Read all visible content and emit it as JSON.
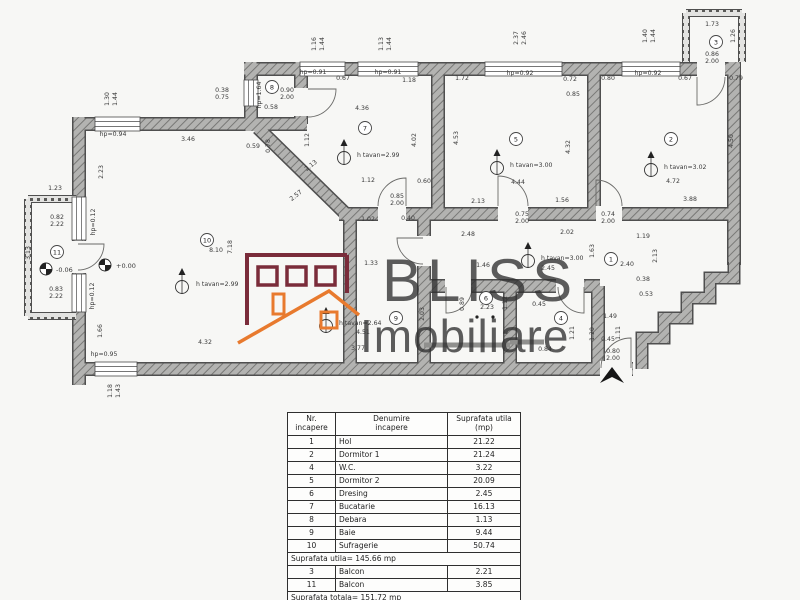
{
  "watermark": {
    "line1": "BLISS",
    "line2": "Imobiliare",
    "brand_maroon": "#7a2c3a",
    "brand_orange": "#e87a2e",
    "text_color": "#303030"
  },
  "plan": {
    "wall_color": "#4f4f4f",
    "dim_color": "#3a3a3a",
    "rooms": [
      {
        "n": "1",
        "x": 611,
        "y": 259
      },
      {
        "n": "2",
        "x": 671,
        "y": 139
      },
      {
        "n": "3",
        "x": 716,
        "y": 42
      },
      {
        "n": "4",
        "x": 561,
        "y": 318
      },
      {
        "n": "5",
        "x": 516,
        "y": 139
      },
      {
        "n": "6",
        "x": 486,
        "y": 298
      },
      {
        "n": "7",
        "x": 365,
        "y": 128
      },
      {
        "n": "8",
        "x": 272,
        "y": 87
      },
      {
        "n": "9",
        "x": 396,
        "y": 318
      },
      {
        "n": "10",
        "x": 207,
        "y": 240
      },
      {
        "n": "11",
        "x": 57,
        "y": 252
      }
    ],
    "ceiling_markers": [
      {
        "label": "h tavan=2.99",
        "tx": 196,
        "ty": 286,
        "mx": 182,
        "my": 282
      },
      {
        "label": "h tavan=2.99",
        "tx": 357,
        "ty": 157,
        "mx": 344,
        "my": 153
      },
      {
        "label": "h tavan=3.00",
        "tx": 510,
        "ty": 167,
        "mx": 497,
        "my": 163
      },
      {
        "label": "h tavan=3.00",
        "tx": 541,
        "ty": 260,
        "mx": 528,
        "my": 256
      },
      {
        "label": "h tavan=3.02",
        "tx": 664,
        "ty": 169,
        "mx": 651,
        "my": 165
      },
      {
        "label": "h tavan=2.64",
        "tx": 339,
        "ty": 325,
        "mx": 326,
        "my": 321
      }
    ],
    "levels": [
      {
        "label": "-0.06",
        "tx": 56,
        "ty": 272,
        "mx": 46,
        "my": 269
      },
      {
        "label": "+0.00",
        "tx": 116,
        "ty": 268,
        "mx": 105,
        "my": 265
      }
    ],
    "dims": [
      {
        "t": "1.16",
        "x": 316,
        "y": 44,
        "r": -90
      },
      {
        "t": "1.44",
        "x": 324,
        "y": 44,
        "r": -90
      },
      {
        "t": "1.13",
        "x": 383,
        "y": 44,
        "r": -90
      },
      {
        "t": "1.44",
        "x": 391,
        "y": 44,
        "r": -90
      },
      {
        "t": "2.37",
        "x": 518,
        "y": 38,
        "r": -90
      },
      {
        "t": "2.46",
        "x": 526,
        "y": 38,
        "r": -90
      },
      {
        "t": "1.40",
        "x": 647,
        "y": 36,
        "r": -90
      },
      {
        "t": "1.44",
        "x": 655,
        "y": 36,
        "r": -90
      },
      {
        "t": "1.30",
        "x": 109,
        "y": 99,
        "r": -90
      },
      {
        "t": "1.44",
        "x": 117,
        "y": 99,
        "r": -90
      },
      {
        "t": "1.18",
        "x": 112,
        "y": 391,
        "r": -90
      },
      {
        "t": "1.43",
        "x": 120,
        "y": 391,
        "r": -90
      },
      {
        "t": "hp=0.91",
        "x": 313,
        "y": 74
      },
      {
        "t": "0.67",
        "x": 343,
        "y": 80
      },
      {
        "t": "hp=0.91",
        "x": 388,
        "y": 74
      },
      {
        "t": "1.18",
        "x": 409,
        "y": 82
      },
      {
        "t": "1.72",
        "x": 462,
        "y": 80
      },
      {
        "t": "hp=0.92",
        "x": 520,
        "y": 75
      },
      {
        "t": "0.72",
        "x": 570,
        "y": 81
      },
      {
        "t": "0.85",
        "x": 573,
        "y": 96
      },
      {
        "t": "0.80",
        "x": 608,
        "y": 80
      },
      {
        "t": "hp=0.92",
        "x": 648,
        "y": 75
      },
      {
        "t": "0.67",
        "x": 685,
        "y": 80
      },
      {
        "t": "0.79",
        "x": 736,
        "y": 80
      },
      {
        "t": "1.73",
        "x": 712,
        "y": 26
      },
      {
        "t": "1.26",
        "x": 735,
        "y": 36,
        "r": -90
      },
      {
        "t": "0.86",
        "x": 712,
        "y": 56
      },
      {
        "t": "2.00",
        "x": 712,
        "y": 63
      },
      {
        "t": "0.38",
        "x": 222,
        "y": 92
      },
      {
        "t": "0.75",
        "x": 222,
        "y": 99
      },
      {
        "t": "hp=1.64",
        "x": 261,
        "y": 95,
        "r": -90
      },
      {
        "t": "0.90",
        "x": 287,
        "y": 92
      },
      {
        "t": "2.00",
        "x": 287,
        "y": 99
      },
      {
        "t": "0.58",
        "x": 271,
        "y": 109
      },
      {
        "t": "0.59",
        "x": 253,
        "y": 148
      },
      {
        "t": "0.78",
        "x": 270,
        "y": 146,
        "r": -90
      },
      {
        "t": "hp=0.94",
        "x": 113,
        "y": 136
      },
      {
        "t": "3.46",
        "x": 188,
        "y": 141
      },
      {
        "t": "2.23",
        "x": 103,
        "y": 172,
        "r": -90
      },
      {
        "t": "1.23",
        "x": 55,
        "y": 190
      },
      {
        "t": "0.82",
        "x": 57,
        "y": 219
      },
      {
        "t": "2.22",
        "x": 57,
        "y": 226
      },
      {
        "t": "hp=0.12",
        "x": 95,
        "y": 222,
        "r": -90
      },
      {
        "t": "3.13",
        "x": 30,
        "y": 253,
        "r": -90
      },
      {
        "t": "0.83",
        "x": 56,
        "y": 291
      },
      {
        "t": "2.22",
        "x": 56,
        "y": 298
      },
      {
        "t": "hp=0.12",
        "x": 94,
        "y": 296,
        "r": -90
      },
      {
        "t": "1.66",
        "x": 102,
        "y": 331,
        "r": -90
      },
      {
        "t": "hp=0.95",
        "x": 104,
        "y": 356
      },
      {
        "t": "4.32",
        "x": 205,
        "y": 344
      },
      {
        "t": "8.10",
        "x": 216,
        "y": 252
      },
      {
        "t": "7.18",
        "x": 232,
        "y": 247,
        "r": -90
      },
      {
        "t": "4.36",
        "x": 362,
        "y": 110
      },
      {
        "t": "1.12",
        "x": 309,
        "y": 140,
        "r": -90
      },
      {
        "t": "2.13",
        "x": 312,
        "y": 167,
        "r": -38
      },
      {
        "t": "2.57",
        "x": 297,
        "y": 197,
        "r": -38
      },
      {
        "t": "1.12",
        "x": 368,
        "y": 182
      },
      {
        "t": "1.02",
        "x": 368,
        "y": 221
      },
      {
        "t": "0.40",
        "x": 408,
        "y": 220
      },
      {
        "t": "0.85",
        "x": 397,
        "y": 198
      },
      {
        "t": "2.00",
        "x": 397,
        "y": 205
      },
      {
        "t": "0.60",
        "x": 424,
        "y": 183
      },
      {
        "t": "4.02",
        "x": 416,
        "y": 140,
        "r": -90
      },
      {
        "t": "4.53",
        "x": 458,
        "y": 138,
        "r": -90
      },
      {
        "t": "4.44",
        "x": 518,
        "y": 184
      },
      {
        "t": "4.32",
        "x": 570,
        "y": 147,
        "r": -90
      },
      {
        "t": "2.13",
        "x": 478,
        "y": 203
      },
      {
        "t": "1.56",
        "x": 562,
        "y": 202
      },
      {
        "t": "0.75",
        "x": 522,
        "y": 216
      },
      {
        "t": "2.00",
        "x": 522,
        "y": 223
      },
      {
        "t": "2.48",
        "x": 468,
        "y": 236
      },
      {
        "t": "2.02",
        "x": 567,
        "y": 234
      },
      {
        "t": "1.19",
        "x": 643,
        "y": 238
      },
      {
        "t": "0.74",
        "x": 608,
        "y": 216
      },
      {
        "t": "2.00",
        "x": 608,
        "y": 223
      },
      {
        "t": "4.72",
        "x": 673,
        "y": 183
      },
      {
        "t": "3.88",
        "x": 690,
        "y": 201
      },
      {
        "t": "4.50",
        "x": 733,
        "y": 141,
        "r": -90
      },
      {
        "t": "2.13",
        "x": 657,
        "y": 256,
        "r": -90
      },
      {
        "t": "2.40",
        "x": 627,
        "y": 266
      },
      {
        "t": "1.46",
        "x": 483,
        "y": 267
      },
      {
        "t": "2.45",
        "x": 548,
        "y": 270
      },
      {
        "t": "1.63",
        "x": 594,
        "y": 251,
        "r": -90
      },
      {
        "t": "0.38",
        "x": 643,
        "y": 281
      },
      {
        "t": "0.53",
        "x": 646,
        "y": 296
      },
      {
        "t": "2.23",
        "x": 487,
        "y": 309
      },
      {
        "t": "0.89",
        "x": 464,
        "y": 304,
        "r": -90
      },
      {
        "t": "1.12",
        "x": 507,
        "y": 303,
        "r": -90
      },
      {
        "t": "0.45",
        "x": 539,
        "y": 306
      },
      {
        "t": "1.21",
        "x": 574,
        "y": 333,
        "r": -90
      },
      {
        "t": "1.20",
        "x": 594,
        "y": 334,
        "r": -90
      },
      {
        "t": "0.84",
        "x": 545,
        "y": 351
      },
      {
        "t": "1.49",
        "x": 610,
        "y": 318
      },
      {
        "t": "1.11",
        "x": 620,
        "y": 333,
        "r": -90
      },
      {
        "t": "0.45",
        "x": 608,
        "y": 341
      },
      {
        "t": "0.80",
        "x": 613,
        "y": 353
      },
      {
        "t": "2.00",
        "x": 613,
        "y": 360
      },
      {
        "t": "1.33",
        "x": 371,
        "y": 265
      },
      {
        "t": "4.51",
        "x": 363,
        "y": 334
      },
      {
        "t": "3.77",
        "x": 358,
        "y": 350
      },
      {
        "t": "2.03",
        "x": 424,
        "y": 314,
        "r": -90
      }
    ]
  },
  "table": {
    "headers": [
      [
        "Nr.",
        "incapere"
      ],
      [
        "Denumire",
        "incapere"
      ],
      [
        "Suprafata utila",
        "(mp)"
      ]
    ],
    "rows": [
      [
        "1",
        "Hol",
        "21.22"
      ],
      [
        "2",
        "Dormitor 1",
        "21.24"
      ],
      [
        "4",
        "W.C.",
        "3.22"
      ],
      [
        "5",
        "Dormitor 2",
        "20.09"
      ],
      [
        "6",
        "Dresing",
        "2.45"
      ],
      [
        "7",
        "Bucatarie",
        "16.13"
      ],
      [
        "8",
        "Debara",
        "1.13"
      ],
      [
        "9",
        "Baie",
        "9.44"
      ],
      [
        "10",
        "Sufragerie",
        "50.74"
      ]
    ],
    "subtotal": "Suprafata utila= 145.66 mp",
    "balcony_rows": [
      [
        "3",
        "Balcon",
        "2.21"
      ],
      [
        "11",
        "Balcon",
        "3.85"
      ]
    ],
    "total": "Suprafata totala= 151.72 mp"
  }
}
